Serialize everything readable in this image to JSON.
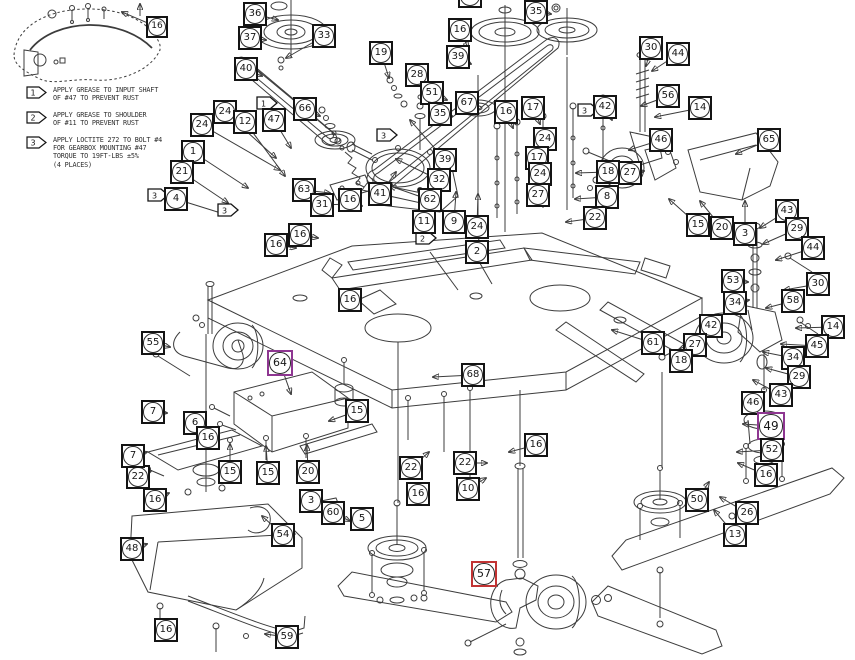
{
  "colors": {
    "box": "#141414",
    "purple": "#8e3691",
    "red": "#c23434",
    "line": "#3c3c3c"
  },
  "notes": [
    {
      "flag": "1",
      "lines": [
        "APPLY GREASE TO INPUT SHAFT",
        "OF #47 TO PREVENT RUST"
      ]
    },
    {
      "flag": "2",
      "lines": [
        "APPLY GREASE TO SHOULDER",
        "OF #11 TO PREVENT RUST"
      ]
    },
    {
      "flag": "3",
      "lines": [
        "APPLY LOCTITE 272 TO BOLT #4",
        "FOR GEARBOX MOUNTING #47",
        "TORQUE TO 19FT-LBS ±5%",
        "(4 PLACES)"
      ]
    }
  ],
  "flags": [
    {
      "num": "1",
      "x": 257,
      "y": 97
    },
    {
      "num": "3",
      "x": 377,
      "y": 129
    },
    {
      "num": "3",
      "x": 148,
      "y": 189
    },
    {
      "num": "3",
      "x": 218,
      "y": 204
    },
    {
      "num": "2",
      "x": 416,
      "y": 232
    },
    {
      "num": "3",
      "x": 578,
      "y": 104
    }
  ],
  "callouts": [
    {
      "n": "16",
      "x": 146,
      "y": 16,
      "s": 22,
      "tx": 122,
      "ty": 12
    },
    {
      "n": "36",
      "x": 243,
      "y": 2,
      "tx": 278,
      "ty": 20
    },
    {
      "n": "37",
      "x": 238,
      "y": 26,
      "tx": 266,
      "ty": 40
    },
    {
      "n": "33",
      "x": 312,
      "y": 24,
      "tx": 286,
      "ty": 58
    },
    {
      "n": "40",
      "x": 234,
      "y": 57,
      "tx": 262,
      "ty": 76
    },
    {
      "n": "19",
      "x": 369,
      "y": 41,
      "tx": 389,
      "ty": 78
    },
    {
      "n": "28",
      "x": 405,
      "y": 63,
      "tx": 428,
      "ty": 86
    },
    {
      "n": "51",
      "x": 420,
      "y": 81,
      "tx": 447,
      "ty": 100
    },
    {
      "n": "35",
      "x": 428,
      "y": 102,
      "tx": 452,
      "ty": 116
    },
    {
      "n": "67",
      "x": 455,
      "y": 91,
      "tx": 477,
      "ty": 107
    },
    {
      "n": "16",
      "x": 448,
      "y": 18,
      "tx": 468,
      "ty": 48
    },
    {
      "n": "39",
      "x": 446,
      "y": 45,
      "tx": 471,
      "ty": 64
    },
    {
      "n": "35",
      "x": 524,
      "y": 0,
      "tx": 551,
      "ty": 14
    },
    {
      "n": "34",
      "x": 458,
      "y": -16
    },
    {
      "n": "66",
      "x": 293,
      "y": 97,
      "tx": 320,
      "ty": 116
    },
    {
      "n": "24",
      "x": 213,
      "y": 100,
      "tx": 276,
      "ty": 158
    },
    {
      "n": "24",
      "x": 190,
      "y": 113,
      "tx": 280,
      "ty": 170
    },
    {
      "n": "12",
      "x": 233,
      "y": 110,
      "tx": 285,
      "ty": 176
    },
    {
      "n": "47",
      "x": 262,
      "y": 108,
      "tx": 291,
      "ty": 148
    },
    {
      "n": "1",
      "x": 181,
      "y": 140,
      "tx": 248,
      "ty": 188
    },
    {
      "n": "21",
      "x": 170,
      "y": 160,
      "tx": 228,
      "ty": 203
    },
    {
      "n": "4",
      "x": 164,
      "y": 187,
      "tx": 224,
      "ty": 214
    },
    {
      "n": "63",
      "x": 292,
      "y": 178,
      "tx": 330,
      "ty": 193
    },
    {
      "n": "31",
      "x": 310,
      "y": 193,
      "tx": 349,
      "ty": 204
    },
    {
      "n": "16",
      "x": 338,
      "y": 188,
      "tx": 362,
      "ty": 206
    },
    {
      "n": "16",
      "x": 288,
      "y": 223,
      "tx": 318,
      "ty": 238
    },
    {
      "n": "16",
      "x": 264,
      "y": 233,
      "tx": 296,
      "ty": 248
    },
    {
      "n": "41",
      "x": 368,
      "y": 182,
      "tx": 396,
      "ty": 172
    },
    {
      "n": "39",
      "x": 433,
      "y": 148,
      "tx": 410,
      "ty": 120
    },
    {
      "n": "32",
      "x": 427,
      "y": 168,
      "tx": 396,
      "ty": 159
    },
    {
      "n": "62",
      "x": 418,
      "y": 188,
      "tx": 390,
      "ty": 186
    },
    {
      "n": "11",
      "x": 412,
      "y": 210,
      "tx": 432,
      "ty": 194
    },
    {
      "n": "9",
      "x": 442,
      "y": 210,
      "tx": 456,
      "ty": 192
    },
    {
      "n": "24",
      "x": 465,
      "y": 215,
      "tx": 478,
      "ty": 194
    },
    {
      "n": "2",
      "x": 465,
      "y": 240,
      "tx": 482,
      "ty": 216
    },
    {
      "n": "16",
      "x": 494,
      "y": 100,
      "tx": 513,
      "ty": 128
    },
    {
      "n": "17",
      "x": 521,
      "y": 96,
      "tx": 540,
      "ty": 124
    },
    {
      "n": "24",
      "x": 533,
      "y": 127,
      "tx": 548,
      "ty": 150
    },
    {
      "n": "17",
      "x": 525,
      "y": 146,
      "tx": 545,
      "ty": 167
    },
    {
      "n": "24",
      "x": 528,
      "y": 162,
      "tx": 546,
      "ty": 182
    },
    {
      "n": "27",
      "x": 526,
      "y": 183,
      "tx": 548,
      "ty": 204
    },
    {
      "n": "42",
      "x": 593,
      "y": 95,
      "tx": 612,
      "ty": 120
    },
    {
      "n": "18",
      "x": 596,
      "y": 160,
      "tx": 576,
      "ty": 173
    },
    {
      "n": "8",
      "x": 595,
      "y": 185,
      "tx": 575,
      "ty": 199
    },
    {
      "n": "22",
      "x": 583,
      "y": 206,
      "tx": 566,
      "ty": 222
    },
    {
      "n": "30",
      "x": 639,
      "y": 36,
      "tx": 646,
      "ty": 66
    },
    {
      "n": "44",
      "x": 666,
      "y": 42,
      "tx": 652,
      "ty": 71
    },
    {
      "n": "56",
      "x": 656,
      "y": 84,
      "tx": 641,
      "ty": 106
    },
    {
      "n": "14",
      "x": 688,
      "y": 96,
      "tx": 655,
      "ty": 117
    },
    {
      "n": "46",
      "x": 649,
      "y": 128,
      "tx": 629,
      "ty": 150
    },
    {
      "n": "27",
      "x": 618,
      "y": 161,
      "tx": 644,
      "ty": 171
    },
    {
      "n": "65",
      "x": 757,
      "y": 128,
      "tx": 736,
      "ty": 154
    },
    {
      "n": "15",
      "x": 686,
      "y": 213,
      "tx": 669,
      "ty": 199
    },
    {
      "n": "20",
      "x": 710,
      "y": 216,
      "tx": 700,
      "ty": 201
    },
    {
      "n": "3",
      "x": 733,
      "y": 222,
      "tx": 745,
      "ty": 201
    },
    {
      "n": "43",
      "x": 775,
      "y": 199,
      "tx": 760,
      "ty": 228
    },
    {
      "n": "29",
      "x": 785,
      "y": 217,
      "tx": 763,
      "ty": 244
    },
    {
      "n": "44",
      "x": 801,
      "y": 236,
      "tx": 776,
      "ty": 260
    },
    {
      "n": "53",
      "x": 721,
      "y": 269,
      "tx": 748,
      "ty": 282
    },
    {
      "n": "34",
      "x": 723,
      "y": 291,
      "tx": 749,
      "ty": 300
    },
    {
      "n": "30",
      "x": 806,
      "y": 272,
      "tx": 784,
      "ty": 290
    },
    {
      "n": "58",
      "x": 781,
      "y": 289,
      "tx": 766,
      "ty": 308
    },
    {
      "n": "42",
      "x": 699,
      "y": 314,
      "tx": 712,
      "ty": 334
    },
    {
      "n": "14",
      "x": 821,
      "y": 315,
      "tx": 796,
      "ty": 328
    },
    {
      "n": "27",
      "x": 683,
      "y": 333,
      "tx": 700,
      "ty": 351
    },
    {
      "n": "45",
      "x": 805,
      "y": 334,
      "tx": 781,
      "ty": 344
    },
    {
      "n": "18",
      "x": 669,
      "y": 349,
      "tx": 689,
      "ty": 360
    },
    {
      "n": "34",
      "x": 781,
      "y": 346,
      "tx": 763,
      "ty": 352
    },
    {
      "n": "29",
      "x": 787,
      "y": 365,
      "tx": 766,
      "ty": 368
    },
    {
      "n": "43",
      "x": 769,
      "y": 383,
      "tx": 753,
      "ty": 380
    },
    {
      "n": "46",
      "x": 741,
      "y": 391,
      "tx": 756,
      "ty": 407
    },
    {
      "n": "61",
      "x": 641,
      "y": 331,
      "tx": 612,
      "ty": 330
    },
    {
      "n": "49",
      "x": 757,
      "y": 412,
      "c": "purple",
      "s": 28,
      "tx": 743,
      "ty": 424
    },
    {
      "n": "52",
      "x": 760,
      "y": 438,
      "tx": 737,
      "ty": 452
    },
    {
      "n": "16",
      "x": 754,
      "y": 463,
      "tx": 738,
      "ty": 463
    },
    {
      "n": "50",
      "x": 685,
      "y": 488,
      "tx": 709,
      "ty": 482
    },
    {
      "n": "26",
      "x": 735,
      "y": 501,
      "tx": 720,
      "ty": 497
    },
    {
      "n": "13",
      "x": 723,
      "y": 523,
      "tx": 714,
      "ty": 510
    },
    {
      "n": "16",
      "x": 524,
      "y": 433,
      "tx": 509,
      "ty": 452
    },
    {
      "n": "22",
      "x": 453,
      "y": 451,
      "tx": 487,
      "ty": 463
    },
    {
      "n": "10",
      "x": 456,
      "y": 477,
      "tx": 486,
      "ty": 478
    },
    {
      "n": "22",
      "x": 399,
      "y": 456,
      "tx": 429,
      "ty": 452
    },
    {
      "n": "16",
      "x": 406,
      "y": 482,
      "tx": 428,
      "ty": 490
    },
    {
      "n": "5",
      "x": 350,
      "y": 507,
      "tx": 372,
      "ty": 526
    },
    {
      "n": "60",
      "x": 321,
      "y": 501,
      "tx": 350,
      "ty": 521
    },
    {
      "n": "3",
      "x": 299,
      "y": 489,
      "tx": 321,
      "ty": 504
    },
    {
      "n": "54",
      "x": 271,
      "y": 523,
      "tx": 262,
      "ty": 516
    },
    {
      "n": "48",
      "x": 120,
      "y": 537,
      "tx": 147,
      "ty": 544
    },
    {
      "n": "16",
      "x": 143,
      "y": 488,
      "tx": 169,
      "ty": 493
    },
    {
      "n": "22",
      "x": 126,
      "y": 465,
      "tx": 151,
      "ty": 471
    },
    {
      "n": "7",
      "x": 121,
      "y": 444,
      "tx": 147,
      "ty": 452
    },
    {
      "n": "7",
      "x": 141,
      "y": 400,
      "tx": 167,
      "ty": 413
    },
    {
      "n": "6",
      "x": 183,
      "y": 411,
      "tx": 204,
      "ty": 427
    },
    {
      "n": "16",
      "x": 196,
      "y": 426,
      "tx": 217,
      "ty": 441
    },
    {
      "n": "15",
      "x": 218,
      "y": 460,
      "tx": 230,
      "ty": 444
    },
    {
      "n": "15",
      "x": 256,
      "y": 461,
      "tx": 266,
      "ty": 446
    },
    {
      "n": "20",
      "x": 296,
      "y": 460,
      "tx": 307,
      "ty": 445
    },
    {
      "n": "15",
      "x": 345,
      "y": 399,
      "tx": 329,
      "ty": 421
    },
    {
      "n": "55",
      "x": 141,
      "y": 331,
      "tx": 170,
      "ty": 347
    },
    {
      "n": "64",
      "x": 267,
      "y": 350,
      "c": "purple",
      "s": 26,
      "tx": 291,
      "ty": 394
    },
    {
      "n": "16",
      "x": 338,
      "y": 288,
      "tx": 361,
      "ty": 303
    },
    {
      "n": "68",
      "x": 461,
      "y": 363,
      "tx": 433,
      "ty": 377
    },
    {
      "n": "16",
      "x": 154,
      "y": 618,
      "tx": 176,
      "ty": 627
    },
    {
      "n": "59",
      "x": 275,
      "y": 625,
      "tx": 265,
      "ty": 634
    },
    {
      "n": "57",
      "x": 471,
      "y": 561,
      "c": "red",
      "s": 26,
      "tx": 497,
      "ty": 586
    }
  ]
}
